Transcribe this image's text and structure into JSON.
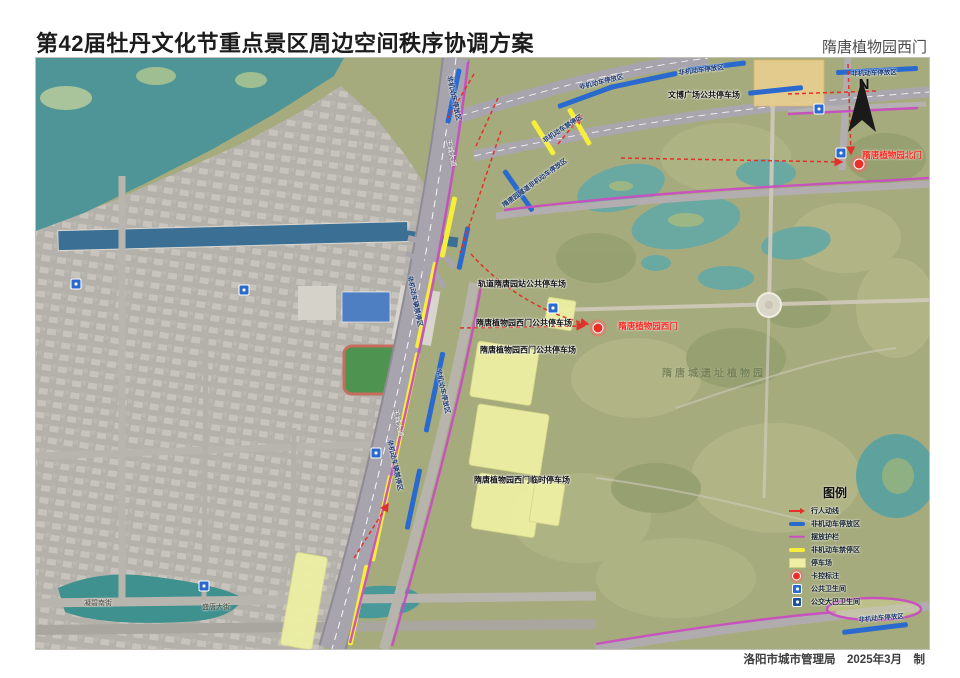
{
  "header": {
    "title": "第42届牡丹文化节重点景区周边空间秩序协调方案",
    "location": "隋唐植物园西门"
  },
  "footer": {
    "credit": "洛阳市城市管理局　2025年3月　制"
  },
  "compass": {
    "label": "N"
  },
  "legend": {
    "title": "图例",
    "items": [
      {
        "label": "行人动线",
        "type": "arrow-red"
      },
      {
        "label": "非机动车停放区",
        "type": "bar-blue"
      },
      {
        "label": "摆放护栏",
        "type": "line-magenta"
      },
      {
        "label": "非机动车禁停区",
        "type": "bar-yellow"
      },
      {
        "label": "停车场",
        "type": "area-lightyellow"
      },
      {
        "label": "卡控标注",
        "type": "dot-red"
      },
      {
        "label": "公共卫生间",
        "type": "toilet-blue"
      },
      {
        "label": "公交大巴卫生间",
        "type": "toilet-dark"
      }
    ]
  },
  "map": {
    "colors": {
      "pedestrian_red": "#e0322a",
      "nonmotor_parking_blue": "#2a6ace",
      "barrier_magenta": "#c84fc0",
      "no_parking_yellow": "#f6ee3b",
      "parking_lot_lightyellow": "#edf0a3",
      "gate_marker_red": "#e8302a",
      "water_teal": "#4f9597",
      "park_green": "#a6ab7d",
      "urban_gray": "#b4b1aa"
    },
    "gate_dots": [
      {
        "x": 562,
        "y": 270
      },
      {
        "x": 823,
        "y": 106
      }
    ],
    "toilets": [
      {
        "x": 40,
        "y": 226
      },
      {
        "x": 208,
        "y": 232
      },
      {
        "x": 340,
        "y": 395
      },
      {
        "x": 783,
        "y": 51
      },
      {
        "x": 805,
        "y": 95
      },
      {
        "x": 168,
        "y": 528
      },
      {
        "x": 517,
        "y": 250
      }
    ],
    "labels": [
      {
        "text": "轨道隋唐园站公共停车场",
        "x": 486,
        "y": 226,
        "cls": "lbl-black"
      },
      {
        "text": "隋唐植物园西门公共停车场",
        "x": 488,
        "y": 265,
        "cls": "lbl-black"
      },
      {
        "text": "隋唐植物园西门公共停车场",
        "x": 492,
        "y": 292,
        "cls": "lbl-black"
      },
      {
        "text": "隋唐植物园西门临时停车场",
        "x": 486,
        "y": 422,
        "cls": "lbl-black"
      },
      {
        "text": "文博广场公共停车场",
        "x": 668,
        "y": 37,
        "cls": "lbl-black"
      },
      {
        "text": "非机动车停放区",
        "x": 565,
        "y": 23,
        "rot": -14,
        "cls": "lbl-road"
      },
      {
        "text": "非机动车停放区",
        "x": 665,
        "y": 11,
        "rot": -7,
        "cls": "lbl-road"
      },
      {
        "text": "非机动车停放区",
        "x": 838,
        "y": 14,
        "rot": -2,
        "cls": "lbl-road"
      },
      {
        "text": "隋唐园隧道非机动车停放区",
        "x": 498,
        "y": 124,
        "rot": -36,
        "cls": "lbl-road"
      },
      {
        "text": "非机动车停放区",
        "x": 408,
        "y": 333,
        "rot": 78,
        "cls": "lbl-road"
      },
      {
        "text": "非机动车辆禁停区",
        "x": 380,
        "y": 243,
        "rot": 78,
        "cls": "lbl-road"
      },
      {
        "text": "非机动车辆禁停区",
        "x": 360,
        "y": 407,
        "rot": 78,
        "cls": "lbl-road"
      },
      {
        "text": "非机动车禁停区",
        "x": 526,
        "y": 70,
        "rot": -33,
        "cls": "lbl-road"
      },
      {
        "text": "非机动车停放区",
        "x": 419,
        "y": 40,
        "rot": 78,
        "cls": "lbl-road"
      },
      {
        "text": "非机动车停放区",
        "x": 845,
        "y": 559,
        "rot": -5,
        "cls": "lbl-road"
      },
      {
        "text": "凝碧南街",
        "x": 62,
        "y": 545,
        "cls": "lbl-street"
      },
      {
        "text": "盛唐大街",
        "x": 180,
        "y": 549,
        "cls": "lbl-street"
      },
      {
        "text": "王城大道",
        "x": 415,
        "y": 95,
        "rot": 78,
        "cls": "lbl-roadname"
      },
      {
        "text": "王城大道",
        "x": 362,
        "y": 365,
        "rot": 78,
        "cls": "lbl-roadname"
      },
      {
        "text": "隋唐城遗址植物园",
        "x": 678,
        "y": 314,
        "cls": "lbl-park"
      },
      {
        "text": "隋唐植物园西门",
        "x": 612,
        "y": 268,
        "cls": "lbl-gate"
      },
      {
        "text": "隋唐植物园北门",
        "x": 856,
        "y": 97,
        "cls": "lbl-gate"
      }
    ]
  }
}
